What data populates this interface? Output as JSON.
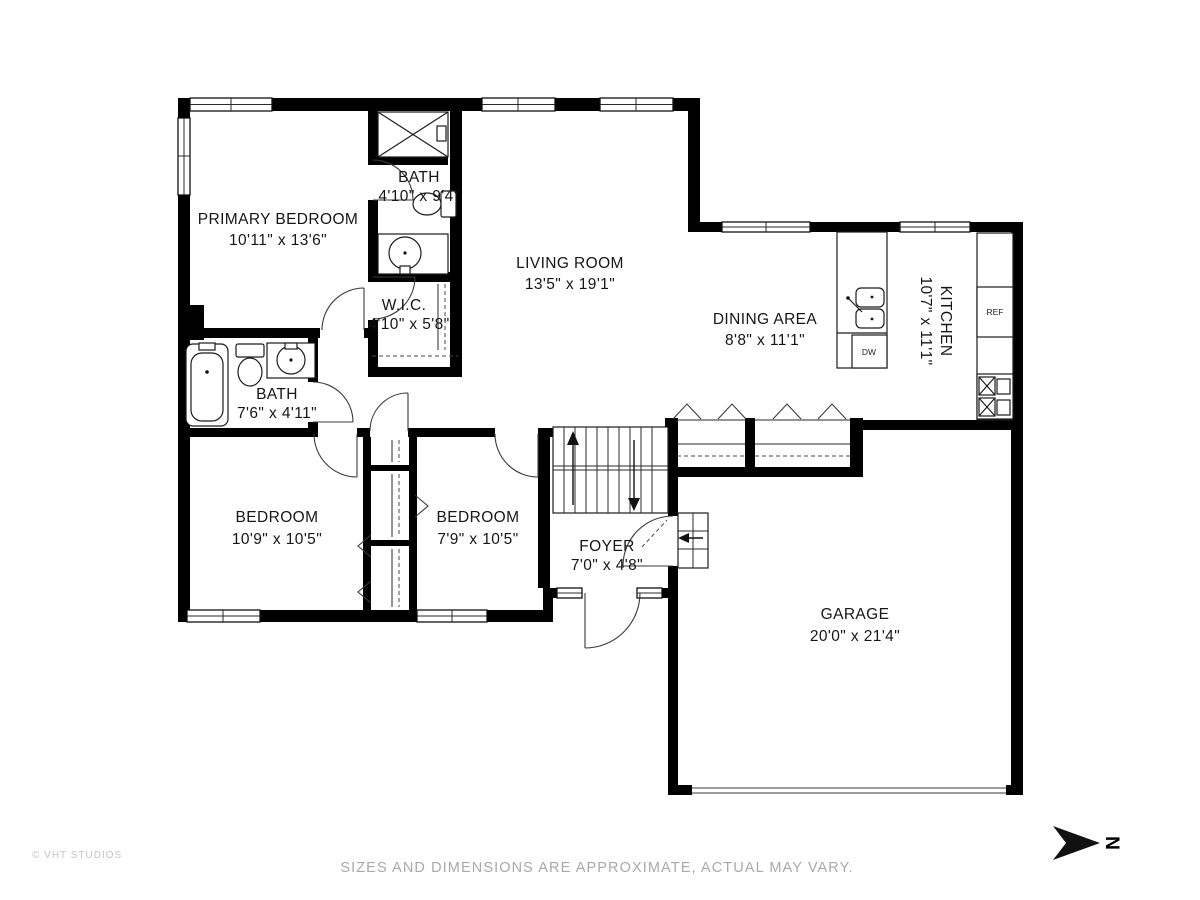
{
  "rooms": [
    {
      "id": "primary-bedroom",
      "name": "PRIMARY BEDROOM",
      "dims": "10'11\" x 13'6\""
    },
    {
      "id": "bath-primary",
      "name": "BATH",
      "dims": "4'10\" x 9'4\""
    },
    {
      "id": "wic",
      "name": "W.I.C.",
      "dims": "4'10\" x 5'8\""
    },
    {
      "id": "living-room",
      "name": "LIVING ROOM",
      "dims": "13'5\" x 19'1\""
    },
    {
      "id": "dining-area",
      "name": "DINING AREA",
      "dims": "8'8\" x 11'1\""
    },
    {
      "id": "kitchen",
      "name": "KITCHEN",
      "dims": "10'7\" x 11'1\""
    },
    {
      "id": "bath-hall",
      "name": "BATH",
      "dims": "7'6\" x 4'11\""
    },
    {
      "id": "bedroom-left",
      "name": "BEDROOM",
      "dims": "10'9\" x 10'5\""
    },
    {
      "id": "bedroom-right",
      "name": "BEDROOM",
      "dims": "7'9\" x 10'5\""
    },
    {
      "id": "foyer",
      "name": "FOYER",
      "dims": "7'0\" x 4'8\""
    },
    {
      "id": "garage",
      "name": "GARAGE",
      "dims": "20'0\" x 21'4\""
    }
  ],
  "appliances": {
    "refrigerator": "REF",
    "dishwasher": "DW"
  },
  "compass": {
    "north_label": "N"
  },
  "footer": {
    "copyright": "© VHT STUDIOS",
    "disclaimer": "SIZES AND DIMENSIONS ARE APPROXIMATE, ACTUAL MAY VARY."
  },
  "colors": {
    "wall": "#000000",
    "background": "#ffffff",
    "muted_text": "#a9a9a9",
    "garage_door": "#9c9c9c"
  }
}
